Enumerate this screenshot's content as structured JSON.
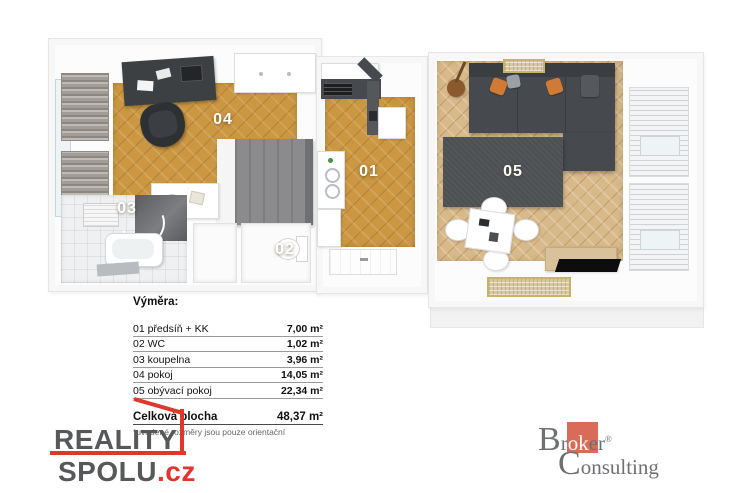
{
  "colors": {
    "accent_red": "#e0372c",
    "logo_salmon": "#d96b58",
    "logo_gray": "#57585a",
    "floor_orange": "#cb9742",
    "floor_wood": "#d8b98a",
    "furniture_dark": "#46494d"
  },
  "plan": {
    "rooms": [
      {
        "number": "01",
        "name": "předsíň + KK"
      },
      {
        "number": "02",
        "name": "WC"
      },
      {
        "number": "03",
        "name": "koupelna"
      },
      {
        "number": "04",
        "name": "pokoj"
      },
      {
        "number": "05",
        "name": "obývací pokoj"
      }
    ]
  },
  "legend": {
    "title": "Výměra:",
    "rows": [
      {
        "label": "01 předsíň + KK",
        "value": "7,00 m²"
      },
      {
        "label": "02 WC",
        "value": "1,02 m²"
      },
      {
        "label": "03 koupelna",
        "value": "3,96 m²"
      },
      {
        "label": "04 pokoj",
        "value": "14,05 m²"
      },
      {
        "label": "05 obývací pokoj",
        "value": "22,34 m²"
      }
    ],
    "total": {
      "label": "Celková plocha",
      "value": "48,37 m²"
    },
    "footnote": "*uvedené rozměry jsou pouze orientační"
  },
  "logos": {
    "reality_spolu": {
      "line1": "REALITY",
      "line2": "SPOLU",
      "tld": ".cz"
    },
    "broker_consulting": {
      "cap1": "B",
      "pre": "r",
      "highlight": "ok",
      "post": "er",
      "registered": "®",
      "cap2": "C",
      "rest2": "onsulting"
    }
  }
}
